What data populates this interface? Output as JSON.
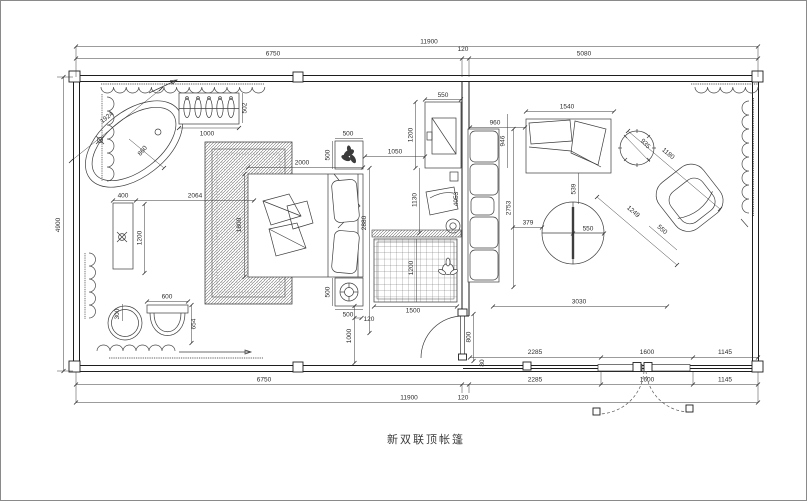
{
  "title": "新双联顶帐篷",
  "colors": {
    "line": "#1e1e1e",
    "furniture": "#3d3d3d",
    "dim_text": "#2d2d2d",
    "background": "#ffffff"
  },
  "dims": {
    "top_total": "11900",
    "top_left": "6750",
    "top_wall": "120",
    "top_right": "5080",
    "left_height": "4900",
    "rail_a": "2285",
    "rail_b": "1600",
    "rail_c": "1145",
    "rail_offset": "80",
    "bot_left": "6750",
    "bot_a": "2285",
    "bot_b": "1600",
    "bot_c": "1145",
    "bot_total": "11900",
    "bot_wall": "120",
    "door_side": "1000",
    "door_gap": "120",
    "door_right": "800",
    "rug_w": "1500",
    "rug_h": "1200",
    "bed_len": "2000",
    "bed_w": "1800",
    "bed_side": "2880",
    "bed_to_tv": "1050",
    "ns_top_w": "500",
    "ns_top_h": "500",
    "ns_bot_h": "500",
    "ns_bot_w": "500",
    "tv_w": "550",
    "tv_h": "1200",
    "chair_dim": "1130",
    "tub_len": "1924",
    "tub_r": "860",
    "vanity_w": "400",
    "vanity_gap": "2064",
    "vanity_len": "1200",
    "wardrobe_w": "1000",
    "wardrobe_d": "502",
    "stool_d": "300",
    "basin_w": "600",
    "basin_d": "654",
    "sofa_gap": "960",
    "sofa_a": "946",
    "sofa_b": "2753",
    "sofa_len": "4053",
    "sofa2_w": "1540",
    "sofa2_gap": "539",
    "table_r": "550",
    "table_gap": "379",
    "living_w": "3030",
    "side_table": "935",
    "chair_diag": "1180",
    "chair_diag2": "1249",
    "chair_w": "550"
  }
}
